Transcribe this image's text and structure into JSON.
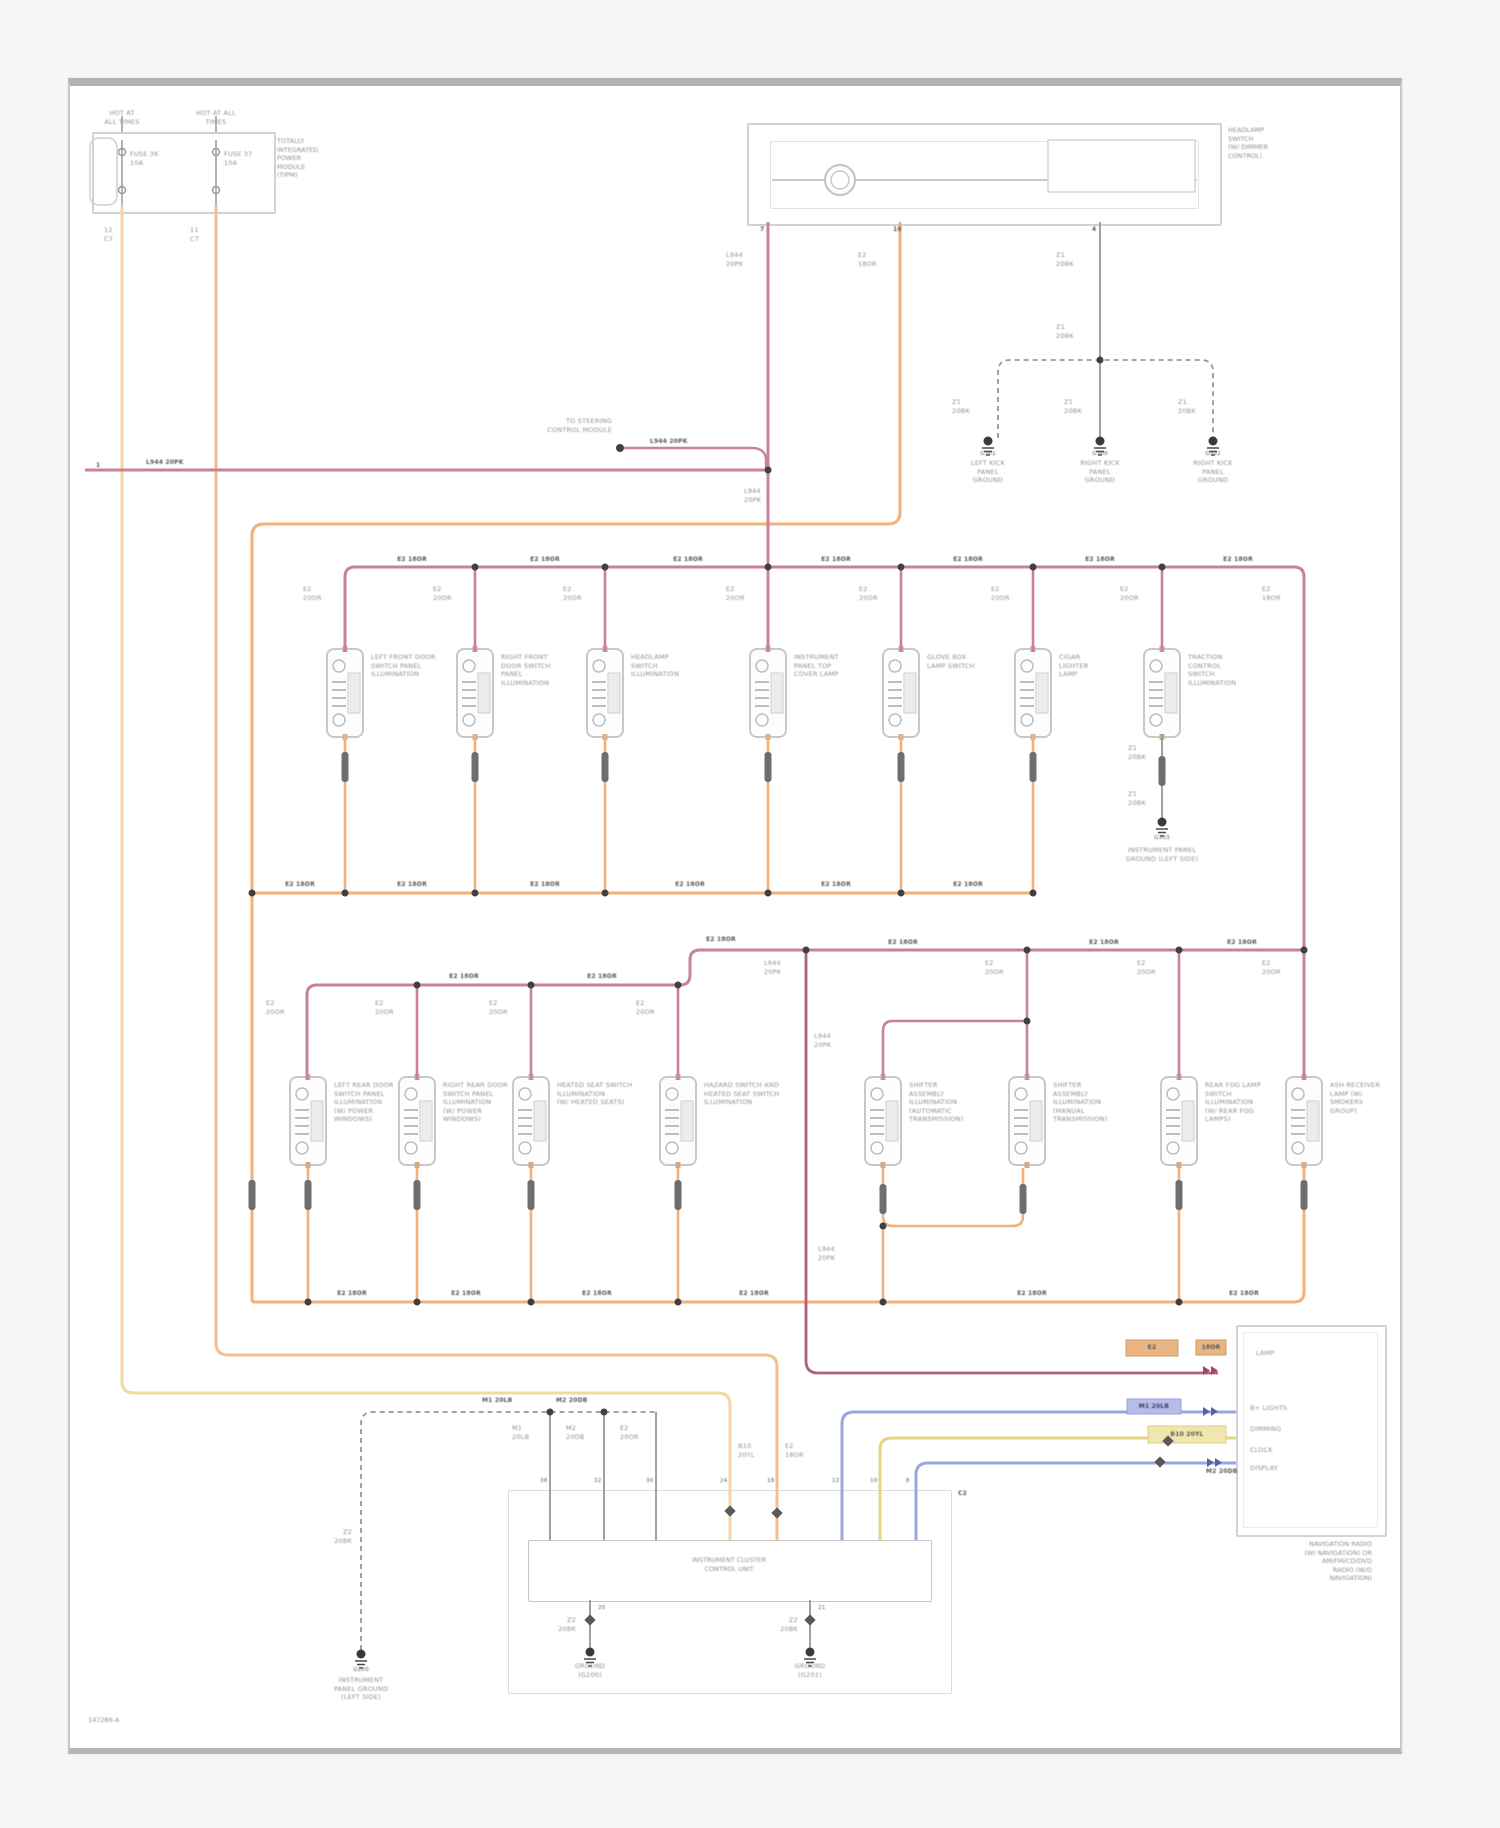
{
  "doc": {
    "footer_code": "147286-A",
    "off_page_ref": "1"
  },
  "colors": {
    "illumination_feed_orange": "#f3b078",
    "fused_b_plus_yellow": "#f2d9a2",
    "dimmer_signal_pink": "#c9809e",
    "dimmer_signal_dark_pink": "#b0607f",
    "bus_blue": "#9ba5e2",
    "bus_yellow": "#ead483",
    "ground_gray": "#979797",
    "frame_gray": "#b3b3b3"
  },
  "modules": {
    "tipm": "TOTALLY\nINTEGRATED\nPOWER\nMODULE\n(TIPM)",
    "headlamp_switch": "HEADLAMP\nSWITCH\n(W/ DIMMER\nCONTROL)",
    "instrument_cluster": "INSTRUMENT CLUSTER\nCONTROL UNIT",
    "radio": "NAVIGATION RADIO\n(W/ NAVIGATION) OR\nAM/FM/CD/DVD\nRADIO (W/O\nNAVIGATION)"
  },
  "labels": [
    {
      "x": 122,
      "y": 109,
      "t": "HOT AT\nALL TIMES",
      "a": "c"
    },
    {
      "x": 216,
      "y": 109,
      "t": "HOT AT ALL\nTIMES",
      "a": "c"
    },
    {
      "x": 130,
      "y": 150,
      "t": "FUSE 36\n10A"
    },
    {
      "x": 224,
      "y": 150,
      "t": "FUSE 37\n10A"
    },
    {
      "x": 104,
      "y": 226,
      "t": "12\nC7"
    },
    {
      "x": 190,
      "y": 226,
      "t": "11\nC7"
    },
    {
      "x": 760,
      "y": 226,
      "t": "7",
      "c": "d"
    },
    {
      "x": 893,
      "y": 226,
      "t": "10",
      "c": "d"
    },
    {
      "x": 1092,
      "y": 226,
      "t": "4",
      "c": "d"
    },
    {
      "x": 726,
      "y": 251,
      "t": "L944\n20PK"
    },
    {
      "x": 858,
      "y": 251,
      "t": "E2\n18OR"
    },
    {
      "x": 1056,
      "y": 251,
      "t": "Z1\n20BK"
    },
    {
      "x": 1056,
      "y": 323,
      "t": "Z1\n20BK"
    },
    {
      "x": 952,
      "y": 398,
      "t": "Z1\n20BK"
    },
    {
      "x": 1064,
      "y": 398,
      "t": "Z1\n20BK"
    },
    {
      "x": 1178,
      "y": 398,
      "t": "Z1\n20BK"
    },
    {
      "x": 988,
      "y": 450,
      "t": "G301",
      "a": "c",
      "c": "d5"
    },
    {
      "x": 1100,
      "y": 450,
      "t": "G300",
      "a": "c",
      "c": "d5"
    },
    {
      "x": 1213,
      "y": 450,
      "t": "G302",
      "a": "c",
      "c": "d5"
    },
    {
      "x": 988,
      "y": 459,
      "t": "LEFT KICK\nPANEL\nGROUND",
      "a": "c"
    },
    {
      "x": 1100,
      "y": 459,
      "t": "RIGHT KICK\nPANEL\nGROUND",
      "a": "c"
    },
    {
      "x": 1213,
      "y": 459,
      "t": "RIGHT KICK\nPANEL\nGROUND",
      "a": "c"
    },
    {
      "x": 96,
      "y": 462,
      "t": "1",
      "c": "d"
    },
    {
      "x": 146,
      "y": 459,
      "t": "L944 20PK",
      "c": "d"
    },
    {
      "x": 612,
      "y": 417,
      "t": "TO STEERING\nCONTROL MODULE",
      "a": "r"
    },
    {
      "x": 650,
      "y": 438,
      "t": "L944 20PK",
      "c": "d"
    },
    {
      "x": 744,
      "y": 487,
      "t": "L944\n20PK"
    },
    {
      "x": 412,
      "y": 556,
      "t": "E2 18OR",
      "a": "c",
      "c": "d"
    },
    {
      "x": 545,
      "y": 556,
      "t": "E2 18OR",
      "a": "c",
      "c": "d"
    },
    {
      "x": 688,
      "y": 556,
      "t": "E2 18OR",
      "a": "c",
      "c": "d"
    },
    {
      "x": 836,
      "y": 556,
      "t": "E2 18OR",
      "a": "c",
      "c": "d"
    },
    {
      "x": 968,
      "y": 556,
      "t": "E2 18OR",
      "a": "c",
      "c": "d"
    },
    {
      "x": 1100,
      "y": 556,
      "t": "E2 18OR",
      "a": "c",
      "c": "d"
    },
    {
      "x": 1238,
      "y": 556,
      "t": "E2 18OR",
      "a": "c",
      "c": "d"
    },
    {
      "x": 303,
      "y": 585,
      "t": "E2\n20OR"
    },
    {
      "x": 433,
      "y": 585,
      "t": "E2\n20OR"
    },
    {
      "x": 563,
      "y": 585,
      "t": "E2\n20OR"
    },
    {
      "x": 726,
      "y": 585,
      "t": "E2\n20OR"
    },
    {
      "x": 859,
      "y": 585,
      "t": "E2\n20OR"
    },
    {
      "x": 991,
      "y": 585,
      "t": "E2\n20OR"
    },
    {
      "x": 1120,
      "y": 585,
      "t": "E2\n20OR"
    },
    {
      "x": 1262,
      "y": 585,
      "t": "E2\n18OR"
    },
    {
      "x": 371,
      "y": 653,
      "t": "LEFT FRONT DOOR\nSWITCH PANEL\nILLUMINATION"
    },
    {
      "x": 501,
      "y": 653,
      "t": "RIGHT FRONT\nDOOR SWITCH\nPANEL\nILLUMINATION"
    },
    {
      "x": 631,
      "y": 653,
      "t": "HEADLAMP\nSWITCH\nILLUMINATION"
    },
    {
      "x": 794,
      "y": 653,
      "t": "INSTRUMENT\nPANEL TOP\nCOVER LAMP"
    },
    {
      "x": 927,
      "y": 653,
      "t": "GLOVE BOX\nLAMP SWITCH"
    },
    {
      "x": 1059,
      "y": 653,
      "t": "CIGAR\nLIGHTER\nLAMP"
    },
    {
      "x": 1188,
      "y": 653,
      "t": "TRACTION\nCONTROL\nSWITCH\nILLUMINATION"
    },
    {
      "x": 1128,
      "y": 744,
      "t": "Z1\n20BK"
    },
    {
      "x": 1128,
      "y": 790,
      "t": "Z1\n20BK"
    },
    {
      "x": 1162,
      "y": 834,
      "t": "G303",
      "a": "c",
      "c": "d5"
    },
    {
      "x": 1162,
      "y": 846,
      "t": "INSTRUMENT PANEL\nGROUND (LEFT SIDE)",
      "a": "c"
    },
    {
      "x": 300,
      "y": 881,
      "t": "E2 18OR",
      "a": "c",
      "c": "d"
    },
    {
      "x": 412,
      "y": 881,
      "t": "E2 18OR",
      "a": "c",
      "c": "d"
    },
    {
      "x": 545,
      "y": 881,
      "t": "E2 18OR",
      "a": "c",
      "c": "d"
    },
    {
      "x": 690,
      "y": 881,
      "t": "E2 18OR",
      "a": "c",
      "c": "d"
    },
    {
      "x": 836,
      "y": 881,
      "t": "E2 18OR",
      "a": "c",
      "c": "d"
    },
    {
      "x": 968,
      "y": 881,
      "t": "E2 18OR",
      "a": "c",
      "c": "d"
    },
    {
      "x": 706,
      "y": 936,
      "t": "E2 18OR",
      "c": "d"
    },
    {
      "x": 903,
      "y": 939,
      "t": "E2 18OR",
      "a": "c",
      "c": "d"
    },
    {
      "x": 1104,
      "y": 939,
      "t": "E2 18OR",
      "a": "c",
      "c": "d"
    },
    {
      "x": 1242,
      "y": 939,
      "t": "E2 18OR",
      "a": "c",
      "c": "d"
    },
    {
      "x": 464,
      "y": 973,
      "t": "E2 18OR",
      "a": "c",
      "c": "d"
    },
    {
      "x": 602,
      "y": 973,
      "t": "E2 18OR",
      "a": "c",
      "c": "d"
    },
    {
      "x": 266,
      "y": 999,
      "t": "E2\n20OR"
    },
    {
      "x": 375,
      "y": 999,
      "t": "E2\n20OR"
    },
    {
      "x": 489,
      "y": 999,
      "t": "E2\n20OR"
    },
    {
      "x": 636,
      "y": 999,
      "t": "E2\n20OR"
    },
    {
      "x": 764,
      "y": 959,
      "t": "L944\n20PK"
    },
    {
      "x": 985,
      "y": 959,
      "t": "E2\n20OR"
    },
    {
      "x": 1137,
      "y": 959,
      "t": "E2\n20OR"
    },
    {
      "x": 1262,
      "y": 959,
      "t": "E2\n20OR"
    },
    {
      "x": 814,
      "y": 1032,
      "t": "L944\n20PK"
    },
    {
      "x": 334,
      "y": 1081,
      "t": "LEFT REAR DOOR\nSWITCH PANEL\nILLUMINATION\n(W/ POWER\nWINDOWS)"
    },
    {
      "x": 443,
      "y": 1081,
      "t": "RIGHT REAR DOOR\nSWITCH PANEL\nILLUMINATION\n(W/ POWER\nWINDOWS)"
    },
    {
      "x": 557,
      "y": 1081,
      "t": "HEATED SEAT SWITCH\nILLUMINATION\n(W/ HEATED SEATS)"
    },
    {
      "x": 704,
      "y": 1081,
      "t": "HAZARD SWITCH AND\nHEATED SEAT SWITCH\nILLUMINATION"
    },
    {
      "x": 909,
      "y": 1081,
      "t": "SHIFTER\nASSEMBLY\nILLUMINATION\n(AUTOMATIC\nTRANSMISSION)"
    },
    {
      "x": 1053,
      "y": 1081,
      "t": "SHIFTER\nASSEMBLY\nILLUMINATION\n(MANUAL\nTRANSMISSION)"
    },
    {
      "x": 1205,
      "y": 1081,
      "t": "REAR FOG LAMP\nSWITCH\nILLUMINATION\n(W/ REAR FOG\nLAMPS)"
    },
    {
      "x": 1330,
      "y": 1081,
      "t": "ASH RECEIVER\nLAMP (W/\nSMOKERS\nGROUP)"
    },
    {
      "x": 352,
      "y": 1290,
      "t": "E2 18OR",
      "a": "c",
      "c": "d"
    },
    {
      "x": 466,
      "y": 1290,
      "t": "E2 18OR",
      "a": "c",
      "c": "d"
    },
    {
      "x": 597,
      "y": 1290,
      "t": "E2 18OR",
      "a": "c",
      "c": "d"
    },
    {
      "x": 754,
      "y": 1290,
      "t": "E2 18OR",
      "a": "c",
      "c": "d"
    },
    {
      "x": 1032,
      "y": 1290,
      "t": "E2 18OR",
      "a": "c",
      "c": "d"
    },
    {
      "x": 1244,
      "y": 1290,
      "t": "E2 18OR",
      "a": "c",
      "c": "d"
    },
    {
      "x": 818,
      "y": 1245,
      "t": "L944\n20PK"
    },
    {
      "x": 352,
      "y": 1528,
      "t": "Z2\n20BK",
      "a": "r"
    },
    {
      "x": 361,
      "y": 1666,
      "t": "G200",
      "a": "c",
      "c": "d5"
    },
    {
      "x": 361,
      "y": 1676,
      "t": "INSTRUMENT\nPANEL GROUND\n(LEFT SIDE)",
      "a": "c"
    },
    {
      "x": 482,
      "y": 1397,
      "t": "M1 20LB",
      "c": "d"
    },
    {
      "x": 556,
      "y": 1397,
      "t": "M2 20DB",
      "c": "d"
    },
    {
      "x": 512,
      "y": 1424,
      "t": "M1\n20LB"
    },
    {
      "x": 566,
      "y": 1424,
      "t": "M2\n20DB"
    },
    {
      "x": 620,
      "y": 1424,
      "t": "E2\n20OR"
    },
    {
      "x": 540,
      "y": 1477,
      "t": "38",
      "c": "d5"
    },
    {
      "x": 594,
      "y": 1477,
      "t": "32",
      "c": "d5"
    },
    {
      "x": 646,
      "y": 1477,
      "t": "30",
      "c": "d5"
    },
    {
      "x": 720,
      "y": 1477,
      "t": "24",
      "c": "d5"
    },
    {
      "x": 767,
      "y": 1477,
      "t": "18",
      "c": "d5"
    },
    {
      "x": 832,
      "y": 1477,
      "t": "12",
      "c": "d5"
    },
    {
      "x": 870,
      "y": 1477,
      "t": "10",
      "c": "d5"
    },
    {
      "x": 906,
      "y": 1477,
      "t": "8",
      "c": "d5"
    },
    {
      "x": 738,
      "y": 1442,
      "t": "B10\n20YL"
    },
    {
      "x": 785,
      "y": 1442,
      "t": "E2\n18OR"
    },
    {
      "x": 958,
      "y": 1490,
      "t": "C2",
      "c": "d"
    },
    {
      "x": 576,
      "y": 1616,
      "t": "Z2\n20BK",
      "a": "r"
    },
    {
      "x": 798,
      "y": 1616,
      "t": "Z2\n20BK",
      "a": "r"
    },
    {
      "x": 590,
      "y": 1662,
      "t": "GROUND\n(G200)",
      "a": "c"
    },
    {
      "x": 810,
      "y": 1662,
      "t": "GROUND\n(G201)",
      "a": "c"
    },
    {
      "x": 598,
      "y": 1604,
      "t": "20",
      "c": "d5"
    },
    {
      "x": 818,
      "y": 1604,
      "t": "21",
      "c": "d5"
    },
    {
      "x": 1256,
      "y": 1349,
      "t": "LAMP"
    },
    {
      "x": 1250,
      "y": 1404,
      "t": "B+ LIGHTS"
    },
    {
      "x": 1250,
      "y": 1425,
      "t": "DIMMING"
    },
    {
      "x": 1250,
      "y": 1446,
      "t": "CLOCK"
    },
    {
      "x": 1250,
      "y": 1464,
      "t": "DISPLAY"
    },
    {
      "x": 1152,
      "y": 1344,
      "t": "E2",
      "a": "c",
      "c": "d"
    },
    {
      "x": 1211,
      "y": 1344,
      "t": "18OR",
      "a": "c",
      "c": "d"
    },
    {
      "x": 1154,
      "y": 1403,
      "t": "M1 20LB",
      "a": "c",
      "c": "db"
    },
    {
      "x": 1187,
      "y": 1431,
      "t": "B10 20YL",
      "a": "c",
      "c": "d"
    },
    {
      "x": 1206,
      "y": 1468,
      "t": "M2 20DB",
      "c": "d"
    }
  ]
}
